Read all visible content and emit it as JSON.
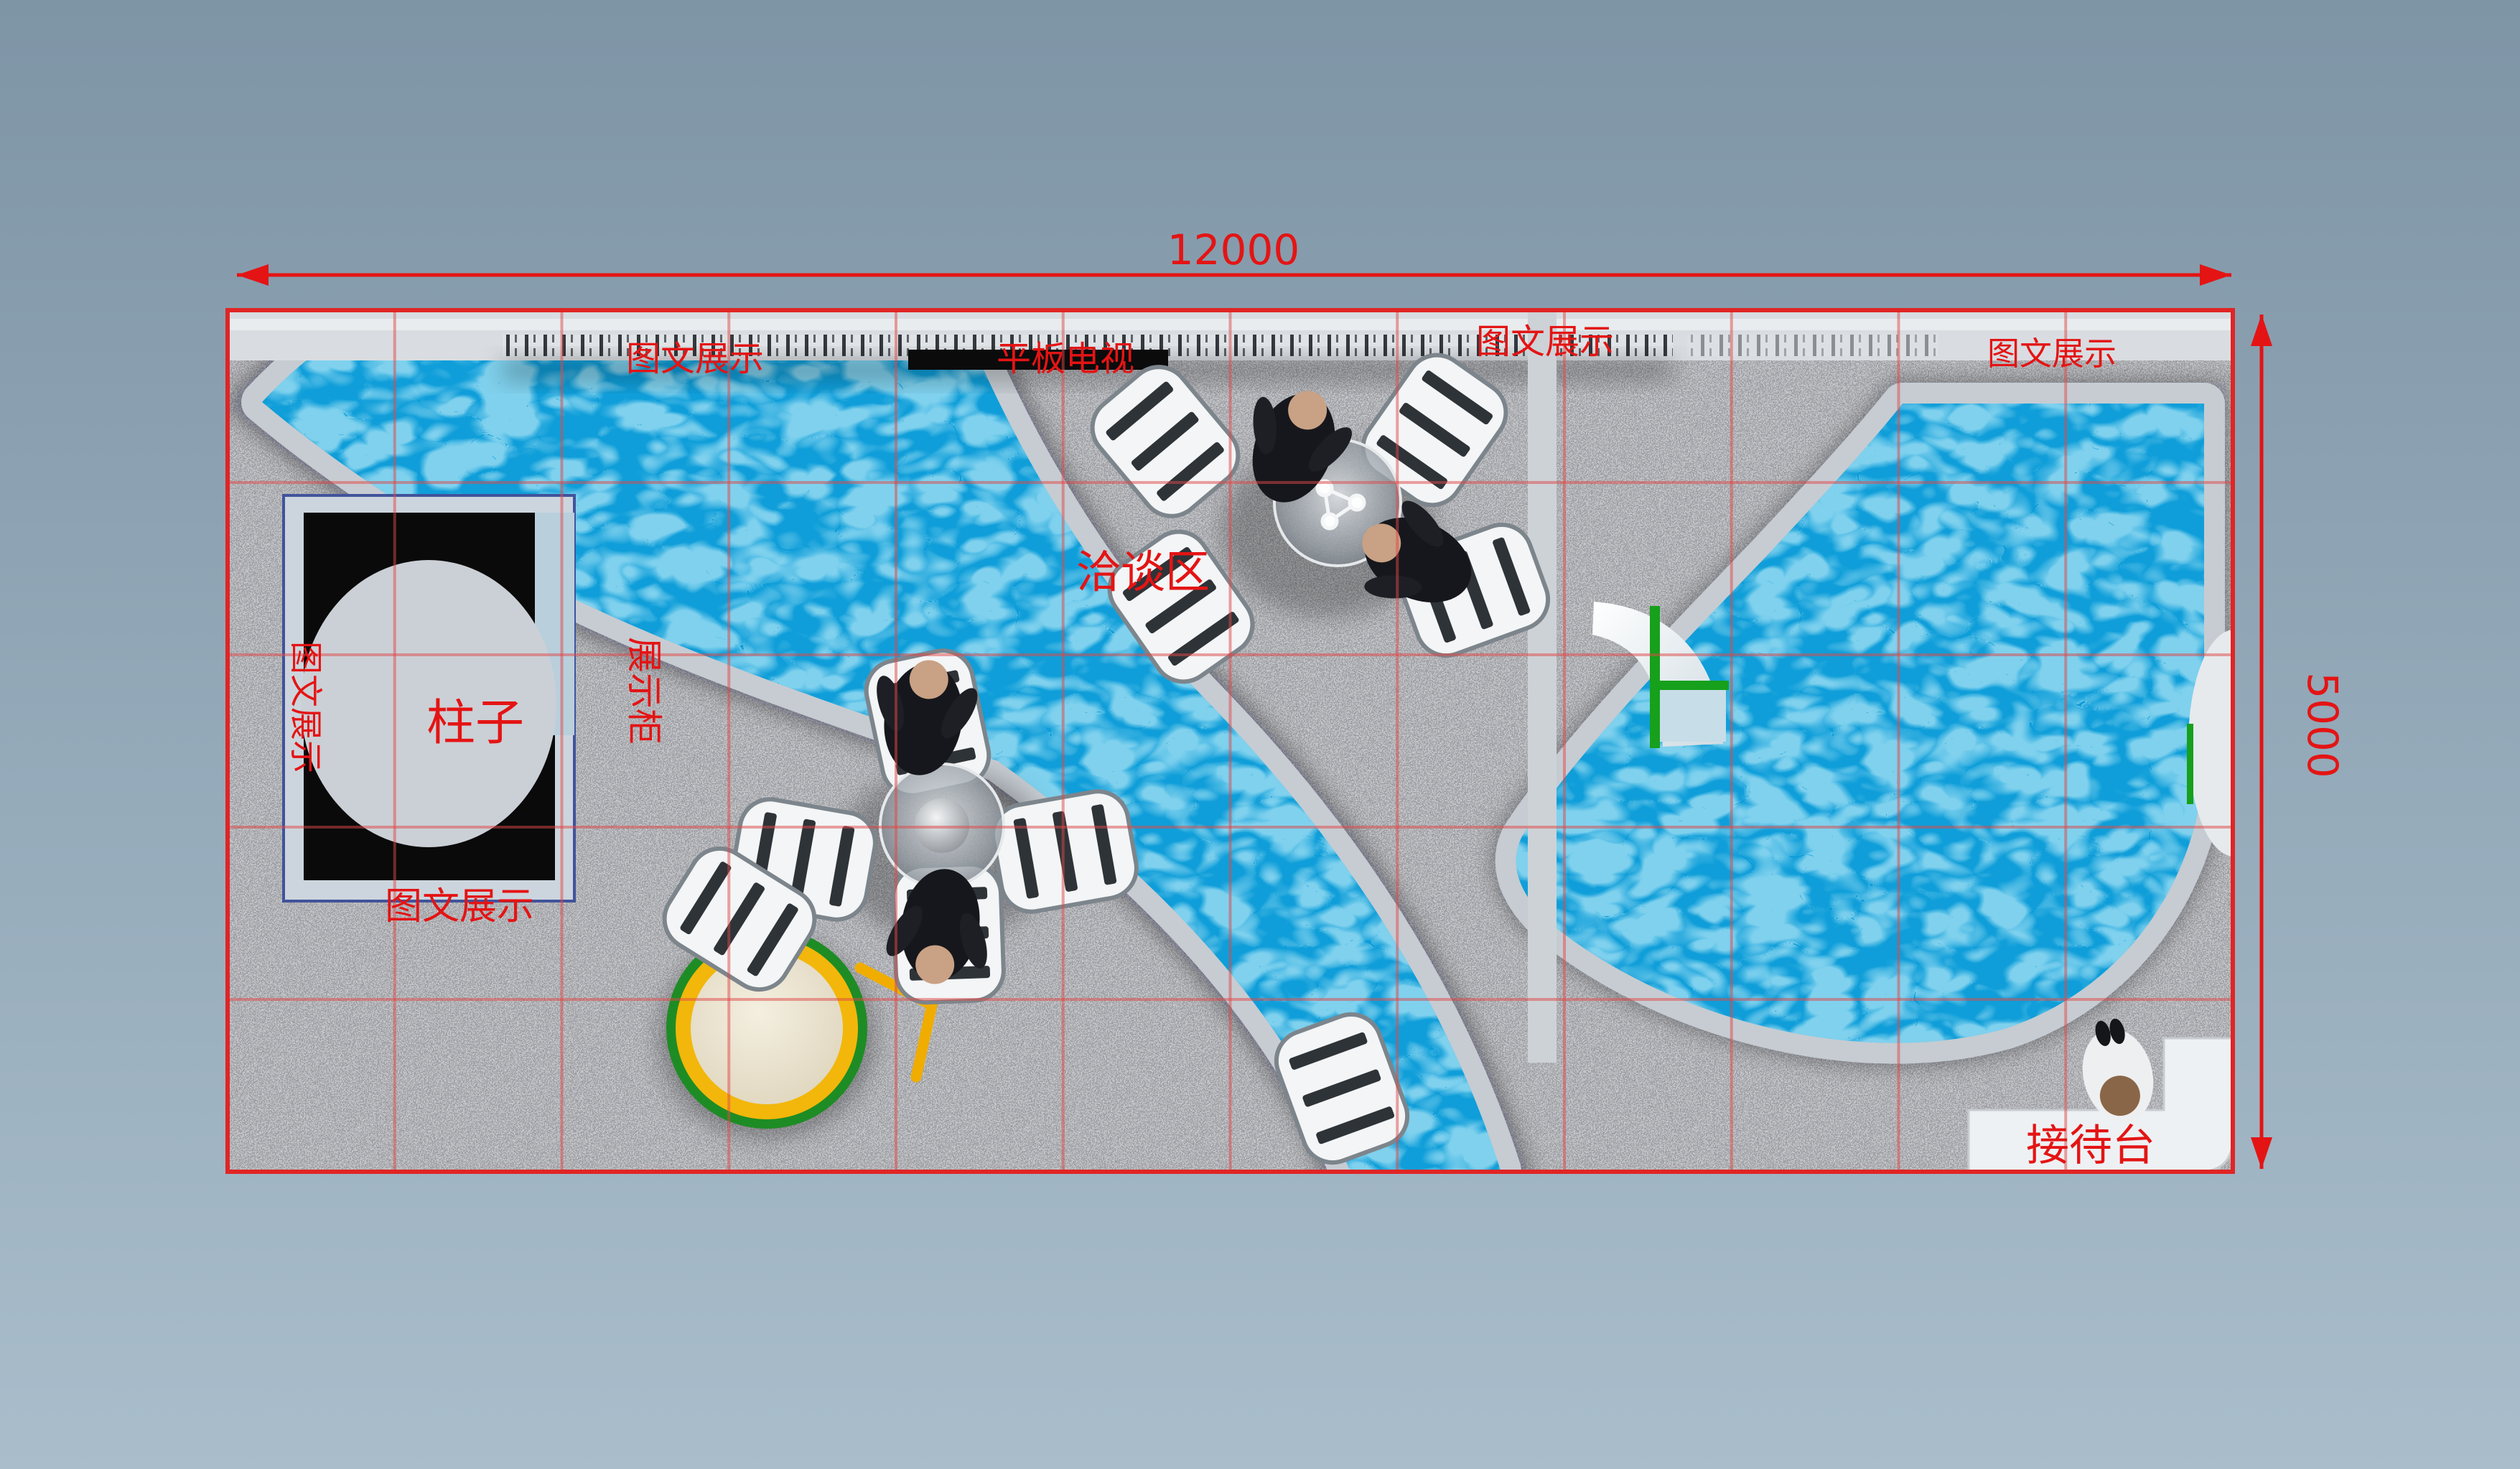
{
  "scene": {
    "title": "展位平面渲染图",
    "type": "exhibition-booth-top-view-render"
  },
  "dimensions": {
    "width_label": "12000",
    "height_label": "5000"
  },
  "labels": {
    "display_top_left": "图文展示",
    "flat_tv": "平板电视",
    "display_top_mid": "图文展示",
    "display_top_right": "图文展示",
    "display_left_vertical": "图文展示",
    "display_cabinet": "展示柜",
    "pillar": "柱子",
    "display_bottom": "图文展示",
    "negotiation_area": "洽谈区",
    "reception_desk": "接待台"
  },
  "grid": {
    "columns": 12,
    "rows": 5,
    "line_color": "#e04848",
    "line_opacity": 0.5,
    "border_color": "#e02525"
  },
  "colors": {
    "annotation_red": "#e41414",
    "water_blue": "#0f9ed9",
    "carpet_gray": "#909298",
    "wall_light": "#d9dde1",
    "band_light": "#c6ccd2",
    "accent_green": "#17a01c",
    "table_yellow": "#f2b70a",
    "background_top": "#7e95a6",
    "background_bottom": "#a9bdcb"
  }
}
